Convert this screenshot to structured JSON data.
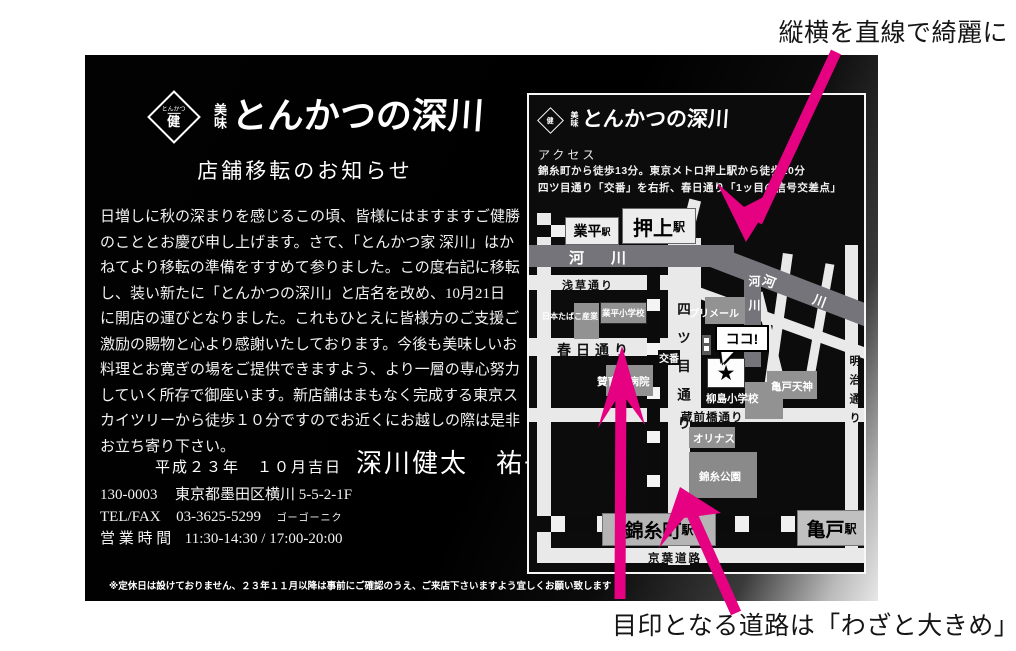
{
  "colors": {
    "pink": "#e60082",
    "road": "#e9e9e9",
    "river": "#74747a",
    "building": "#929292",
    "card_black": "#000000",
    "silver": "#e7e7e7"
  },
  "annotations": {
    "top_note": "縦横を直線で綺麗に",
    "bottom_note": "目印となる道路は「わざと大きめ」"
  },
  "card": {
    "logo": {
      "mark_line1": "とんかつ",
      "mark_line2": "健",
      "prefix_stack": "美味",
      "name": "とんかつの深川"
    },
    "title": "店舗移転のお知らせ",
    "body_lines": [
      "日増しに秋の深まりを感じるこの頃、皆様にはますますご健勝",
      "のこととお慶び申し上げます。さて、「とんかつ家 深川」はか",
      "ねてより移転の準備をすすめて参りました。この度右記に移転",
      "し、装い新たに「とんかつの深川」と店名を改め、10月21日",
      "に開店の運びとなりました。これもひとえに皆様方のご支援ご",
      "激励の賜物と心より感謝いたしております。今後も美味しいお",
      "料理とお寛ぎの場をご提供できますよう、より一層の専心努力",
      "していく所存で御座います。新店舗はまもなく完成する東京ス",
      "カイツリーから徒歩１０分ですのでお近くにお越しの際は是非",
      "お立ち寄り下さい。"
    ],
    "closing": {
      "date": "平成２３年　１０月吉日",
      "names": "深川健太　祐子"
    },
    "address": {
      "postal": "130-0003",
      "street": "東京都墨田区横川 5-5-2-1F",
      "tel_label": "TEL/FAX",
      "tel_number": "03-3625-5299",
      "tel_kana": "ゴーゴーニク",
      "hours_label": "営 業 時 間",
      "hours": "11:30-14:30 / 17:00-20:00"
    },
    "footnote": "※定休日は設けておりません、２３年１１月以降は事前にご確認のうえ、ご来店下さいますよう宜しくお願い致します"
  },
  "map": {
    "logo": {
      "prefix_stack": "美味",
      "name": "とんかつの深川",
      "mark": "健"
    },
    "access": {
      "title": "アクセス",
      "line1": "錦糸町から徒歩13分。東京メトロ押上駅から徒歩10分",
      "line2": "四ツ目通り「交番」を右折、春日通り「1ッ目の信号交差点」"
    },
    "stations": {
      "narihira": {
        "name": "業平",
        "suffix": "駅"
      },
      "oshiage": {
        "name": "押上",
        "suffix": "駅"
      },
      "kinshicho": {
        "name": "錦糸町",
        "suffix": "駅"
      },
      "kameido": {
        "name": "亀戸",
        "suffix": "駅"
      }
    },
    "roads": {
      "asakusa": "浅草通り",
      "kasuga": "春日通り",
      "kuramae": "蔵前橋通り",
      "keiyo": "京葉道路",
      "yotsume": "四ツ目通り",
      "meiji": "明治通り"
    },
    "rivers": {
      "horizontal": "河　川",
      "diagonal": "河　川",
      "vertical": "河川"
    },
    "buildings": {
      "jt": "日本たばこ産業",
      "narihira_es": "業平小学校",
      "primeel": "プリメール",
      "sanikukai": "賛育会病院",
      "yanagishima_es": "柳島小学校",
      "kameido_tenjin": "亀戸天神",
      "olinas": "オリナス",
      "kinshi_park": "錦糸公園"
    },
    "markers": {
      "koban": "交番",
      "koko": "ココ!",
      "star": "★"
    }
  }
}
